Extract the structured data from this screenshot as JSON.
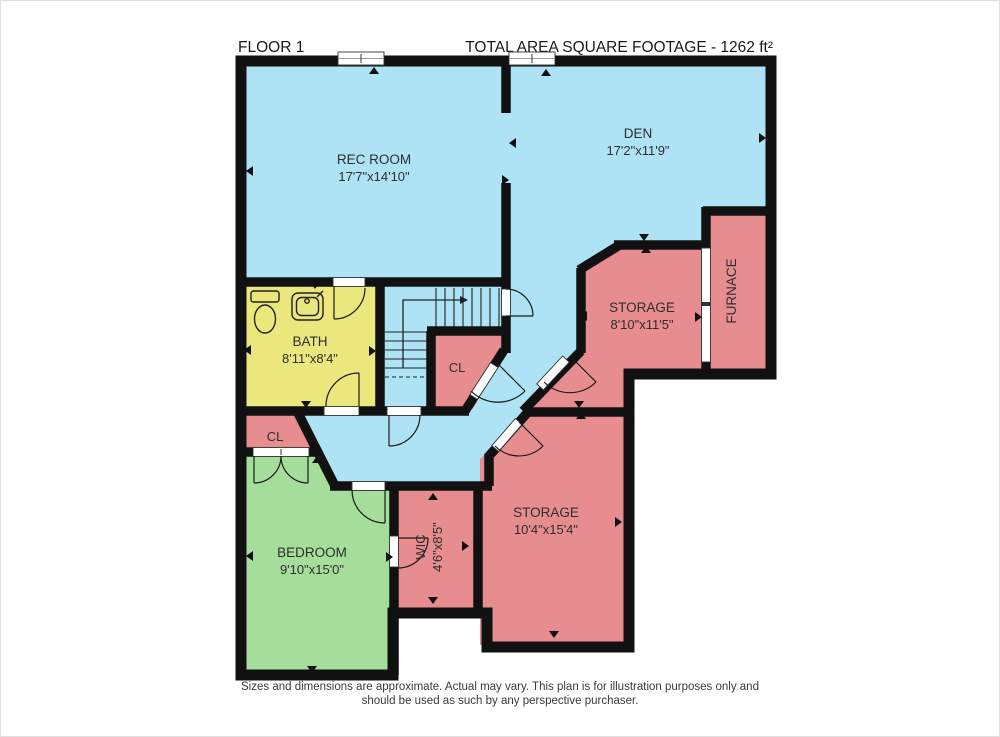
{
  "header": {
    "floor_label": "FLOOR 1",
    "total_area": "TOTAL AREA SQUARE FOOTAGE - 1262 ft²"
  },
  "rooms": {
    "rec_room": {
      "name": "REC ROOM",
      "dims": "17'7\"x14'10\""
    },
    "den": {
      "name": "DEN",
      "dims": "17'2\"x11'9\""
    },
    "bath": {
      "name": "BATH",
      "dims": "8'11\"x8'4\""
    },
    "closet_hall": {
      "name": "CL"
    },
    "storage_upper": {
      "name": "STORAGE",
      "dims": "8'10\"x11'5\""
    },
    "furnace": {
      "name": "FURNACE"
    },
    "closet_bedroom": {
      "name": "CL"
    },
    "bedroom": {
      "name": "BEDROOM",
      "dims": "9'10\"x15'0\""
    },
    "wic": {
      "name": "WIC",
      "dims": "4'6\"x8'5\""
    },
    "storage_lower": {
      "name": "STORAGE",
      "dims": "10'4\"x15'4\""
    }
  },
  "footer": {
    "line1": "Sizes and dimensions are approximate. Actual may vary. This plan is for illustration purposes only and",
    "line2": "should be used as such by any perspective purchaser."
  },
  "colors": {
    "room_blue": "#aee3f6",
    "room_pink": "#e78d90",
    "room_green": "#a5dd9b",
    "room_yellow": "#eae77d",
    "wall": "#111111",
    "background": "#ffffff"
  }
}
